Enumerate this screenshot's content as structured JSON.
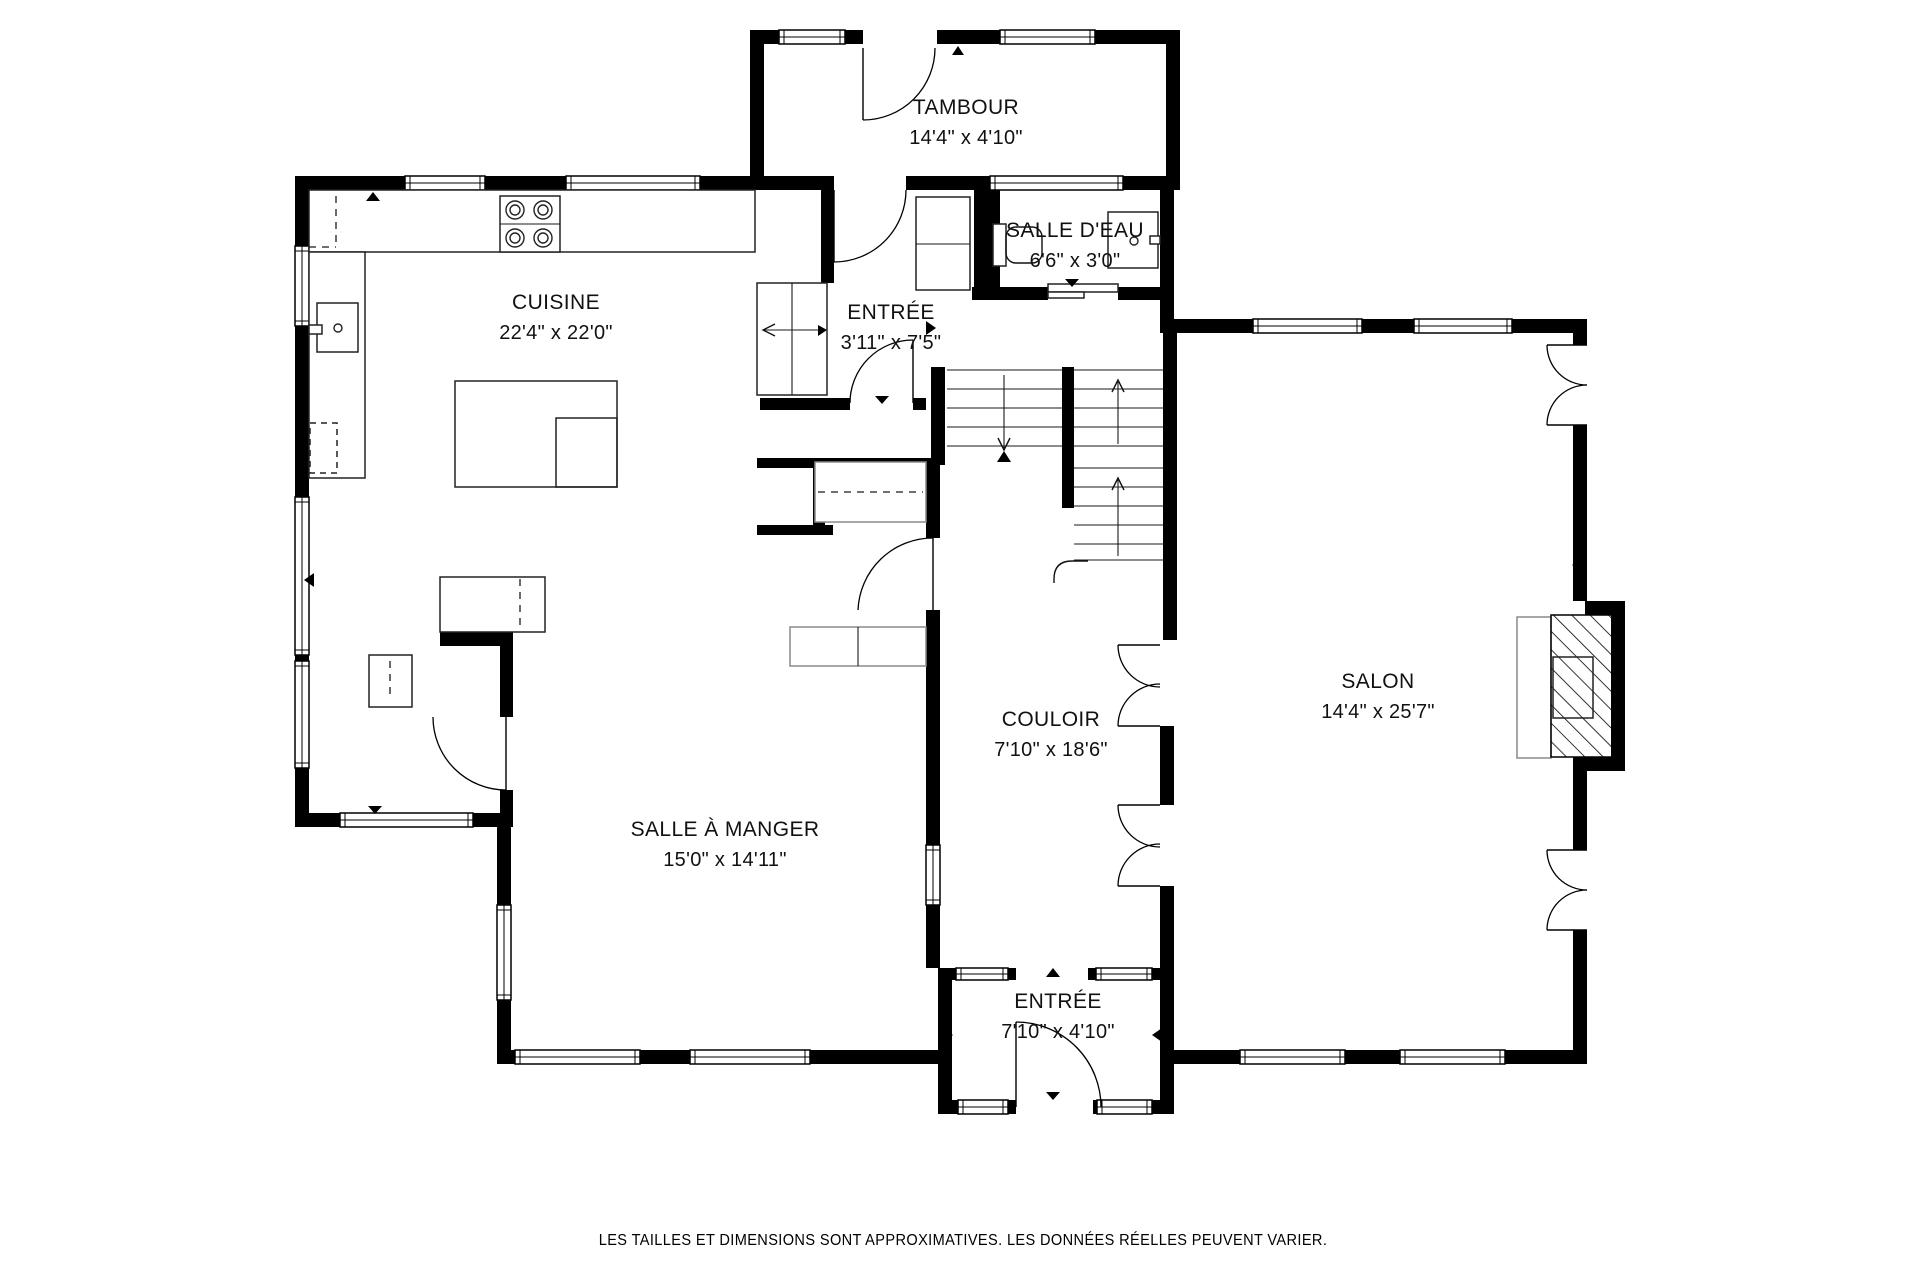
{
  "footer": {
    "disclaimer": "LES TAILLES ET DIMENSIONS SONT APPROXIMATIVES. LES DONNÉES RÉELLES PEUVENT VARIER."
  },
  "rooms": {
    "tambour": {
      "name": "TAMBOUR",
      "dims": "14'4\" x 4'10\"",
      "x": 966,
      "y": 96
    },
    "salle_deau": {
      "name": "SALLE D'EAU",
      "dims": "6'6\" x 3'0\"",
      "x": 1075,
      "y": 219
    },
    "entree_haut": {
      "name": "ENTRÉE",
      "dims": "3'11\" x 7'5\"",
      "x": 891,
      "y": 301
    },
    "cuisine": {
      "name": "CUISINE",
      "dims": "22'4\" x 22'0\"",
      "x": 556,
      "y": 291
    },
    "couloir": {
      "name": "COULOIR",
      "dims": "7'10\" x 18'6\"",
      "x": 1051,
      "y": 708
    },
    "salon": {
      "name": "SALON",
      "dims": "14'4\" x 25'7\"",
      "x": 1378,
      "y": 670
    },
    "salle_a_manger": {
      "name": "SALLE À MANGER",
      "dims": "15'0\" x 14'11\"",
      "x": 725,
      "y": 818
    },
    "entree_bas": {
      "name": "ENTRÉE",
      "dims": "7'10\" x 4'10\"",
      "x": 1058,
      "y": 990
    }
  },
  "colors": {
    "wall": "#000000",
    "line": "#1a1a1a",
    "gray": "#8a8a8a",
    "paper": "#ffffff"
  },
  "plan": {
    "walls": [
      [
        750,
        30,
        14,
        160
      ],
      [
        1166,
        30,
        14,
        160
      ],
      [
        750,
        30,
        29,
        14
      ],
      [
        845,
        30,
        18,
        14
      ],
      [
        937,
        30,
        63,
        14
      ],
      [
        1095,
        30,
        85,
        14
      ],
      [
        295,
        176,
        110,
        14
      ],
      [
        485,
        176,
        81,
        14
      ],
      [
        700,
        176,
        134,
        14
      ],
      [
        906,
        176,
        84,
        14
      ],
      [
        1123,
        176,
        57,
        14
      ],
      [
        295,
        176,
        14,
        70
      ],
      [
        295,
        326,
        14,
        171
      ],
      [
        295,
        655,
        14,
        6
      ],
      [
        295,
        768,
        14,
        59
      ],
      [
        295,
        813,
        45,
        14
      ],
      [
        473,
        813,
        40,
        14
      ],
      [
        497,
        827,
        14,
        78
      ],
      [
        497,
        1000,
        14,
        64
      ],
      [
        497,
        1050,
        18,
        14
      ],
      [
        640,
        1050,
        50,
        14
      ],
      [
        810,
        1050,
        142,
        14
      ],
      [
        440,
        632,
        73,
        14
      ],
      [
        500,
        646,
        13,
        71
      ],
      [
        500,
        790,
        13,
        37
      ],
      [
        821,
        190,
        13,
        93
      ],
      [
        760,
        398,
        90,
        12
      ],
      [
        913,
        398,
        13,
        12
      ],
      [
        974,
        190,
        26,
        110
      ],
      [
        1160,
        190,
        14,
        143
      ],
      [
        972,
        287,
        76,
        13
      ],
      [
        1118,
        287,
        56,
        13
      ],
      [
        757,
        458,
        178,
        10
      ],
      [
        813,
        468,
        12,
        57
      ],
      [
        757,
        525,
        76,
        10
      ],
      [
        926,
        460,
        14,
        78
      ],
      [
        926,
        610,
        14,
        235
      ],
      [
        926,
        905,
        14,
        63
      ],
      [
        931,
        367,
        14,
        98
      ],
      [
        1062,
        367,
        12,
        141
      ],
      [
        1163,
        333,
        14,
        307
      ],
      [
        1160,
        726,
        14,
        79
      ],
      [
        1160,
        886,
        14,
        82
      ],
      [
        938,
        968,
        14,
        146
      ],
      [
        1160,
        968,
        14,
        146
      ],
      [
        938,
        968,
        19,
        12
      ],
      [
        1008,
        968,
        8,
        12
      ],
      [
        1088,
        968,
        8,
        12
      ],
      [
        1152,
        968,
        22,
        12
      ],
      [
        938,
        1100,
        20,
        14
      ],
      [
        1008,
        1100,
        8,
        14
      ],
      [
        1093,
        1100,
        4,
        14
      ],
      [
        1152,
        1100,
        22,
        14
      ],
      [
        1174,
        319,
        79,
        14
      ],
      [
        1362,
        319,
        52,
        14
      ],
      [
        1512,
        319,
        75,
        14
      ],
      [
        1573,
        319,
        14,
        26
      ],
      [
        1573,
        425,
        14,
        176
      ],
      [
        1585,
        601,
        40,
        14
      ],
      [
        1611,
        601,
        14,
        170
      ],
      [
        1585,
        757,
        40,
        14
      ],
      [
        1573,
        757,
        14,
        93
      ],
      [
        1573,
        930,
        14,
        134
      ],
      [
        1174,
        1050,
        66,
        14
      ],
      [
        1345,
        1050,
        55,
        14
      ],
      [
        1505,
        1050,
        82,
        14
      ]
    ],
    "windows": [
      [
        779,
        30,
        66,
        14
      ],
      [
        1000,
        30,
        95,
        14
      ],
      [
        405,
        176,
        80,
        14
      ],
      [
        566,
        176,
        134,
        14
      ],
      [
        990,
        176,
        133,
        14
      ],
      [
        295,
        246,
        14,
        80
      ],
      [
        295,
        497,
        14,
        158
      ],
      [
        295,
        661,
        14,
        107
      ],
      [
        340,
        813,
        133,
        14
      ],
      [
        497,
        905,
        14,
        95
      ],
      [
        515,
        1050,
        125,
        14
      ],
      [
        690,
        1050,
        120,
        14
      ],
      [
        926,
        845,
        14,
        60
      ],
      [
        956,
        968,
        52,
        12
      ],
      [
        1096,
        968,
        56,
        12
      ],
      [
        958,
        1100,
        50,
        14
      ],
      [
        1097,
        1100,
        55,
        14
      ],
      [
        1253,
        319,
        109,
        14
      ],
      [
        1414,
        319,
        98,
        14
      ],
      [
        1240,
        1050,
        105,
        14
      ],
      [
        1400,
        1050,
        105,
        14
      ]
    ],
    "thin": [
      [
        309,
        190,
        446,
        62,
        "kitchen-counter-top",
        0
      ],
      [
        309,
        252,
        56,
        226,
        "kitchen-counter-left",
        0
      ],
      [
        500,
        196,
        60,
        56,
        "stove",
        0
      ],
      [
        317,
        303,
        41,
        49,
        "kitchen-sink",
        0
      ],
      [
        309,
        325,
        13,
        9,
        "sink-faucet",
        0
      ],
      [
        310,
        423,
        27,
        50,
        "dishwasher",
        2
      ],
      [
        455,
        381,
        162,
        106,
        "kitchen-island",
        0
      ],
      [
        556,
        418,
        61,
        69,
        "island-inner",
        4
      ],
      [
        757,
        283,
        70,
        112,
        "entry-closet",
        0
      ],
      [
        916,
        197,
        54,
        93,
        "hall-cabinet",
        0
      ],
      [
        815,
        462,
        111,
        60,
        "coat-closet",
        1
      ],
      [
        440,
        577,
        105,
        55,
        "cabinet-counter",
        0
      ],
      [
        369,
        655,
        43,
        52,
        "small-cabinet",
        0
      ],
      [
        790,
        627,
        136,
        39,
        "hall-bench",
        1
      ],
      [
        1517,
        617,
        34,
        141,
        "hearth",
        1
      ],
      [
        1551,
        615,
        61,
        142,
        "fireplace",
        3
      ],
      [
        1553,
        657,
        40,
        61,
        "fireplace-insert",
        4
      ],
      [
        993,
        224,
        13,
        42,
        "toilet-tank",
        0
      ],
      [
        1108,
        212,
        50,
        56,
        "powder-sink",
        0
      ],
      [
        1150,
        236,
        10,
        8,
        "powder-faucet",
        0
      ],
      [
        1048,
        284,
        70,
        8,
        "pocket-door",
        0
      ],
      [
        1048,
        292,
        36,
        6,
        "pocket-door-track",
        0
      ]
    ],
    "lines": [
      [
        792,
        283,
        792,
        395
      ],
      [
        858,
        627,
        858,
        666
      ],
      [
        500,
        224,
        560,
        224
      ],
      [
        916,
        244,
        970,
        244
      ],
      [
        947,
        370,
        1062,
        370
      ],
      [
        947,
        389,
        1062,
        389
      ],
      [
        947,
        408,
        1062,
        408
      ],
      [
        947,
        427,
        1062,
        427
      ],
      [
        947,
        446,
        1062,
        446
      ],
      [
        1074,
        370,
        1163,
        370
      ],
      [
        1074,
        389,
        1163,
        389
      ],
      [
        1074,
        408,
        1163,
        408
      ],
      [
        1074,
        427,
        1163,
        427
      ],
      [
        1074,
        446,
        1163,
        446
      ],
      [
        1074,
        468,
        1163,
        468
      ],
      [
        1074,
        487,
        1163,
        487
      ],
      [
        1074,
        506,
        1163,
        506
      ],
      [
        1074,
        525,
        1163,
        525
      ],
      [
        1074,
        544,
        1163,
        544
      ],
      [
        1074,
        560,
        1163,
        560
      ],
      [
        1118,
        382,
        1118,
        444
      ],
      [
        1118,
        480,
        1118,
        556
      ],
      [
        1004,
        375,
        1004,
        448
      ],
      [
        763,
        330,
        824,
        330
      ]
    ],
    "dashed": [
      [
        336,
        196,
        336,
        247
      ],
      [
        309,
        247,
        336,
        247
      ],
      [
        818,
        492,
        923,
        492
      ],
      [
        520,
        579,
        520,
        630
      ],
      [
        390,
        661,
        390,
        700
      ]
    ],
    "doors": [
      [
        863,
        48,
        863,
        120,
        "M863,120 A72,72 0 0 0 935,48"
      ],
      [
        834,
        190,
        834,
        262,
        "M834,262 A72,72 0 0 0 906,190"
      ],
      [
        913,
        340,
        913,
        403,
        "M850,403 A63,63 0 0 1 913,340"
      ],
      [
        506,
        717,
        506,
        790,
        "M506,790 A73,73 0 0 1 433,717"
      ],
      [
        933,
        538,
        933,
        610,
        "M933,538 A75,75 0 0 0 858,610"
      ],
      [
        1016,
        1022,
        1016,
        1107,
        "M1016,1022 A85,85 0 0 1 1101,1107"
      ],
      [
        1160,
        645,
        1118,
        645,
        "M1118,645 A42,42 0 0 0 1160,687"
      ],
      [
        1160,
        726,
        1118,
        726,
        "M1118,726 A42,42 0 0 1 1160,684"
      ],
      [
        1160,
        805,
        1118,
        805,
        "M1118,805 A42,42 0 0 0 1160,847"
      ],
      [
        1160,
        886,
        1118,
        886,
        "M1118,886 A42,42 0 0 1 1160,844"
      ],
      [
        1587,
        345,
        1547,
        345,
        "M1547,345 A40,40 0 0 0 1587,385"
      ],
      [
        1587,
        425,
        1547,
        425,
        "M1547,425 A40,40 0 0 1 1587,385"
      ],
      [
        1587,
        850,
        1547,
        850,
        "M1547,850 A40,40 0 0 0 1587,890"
      ],
      [
        1587,
        930,
        1547,
        930,
        "M1547,930 A40,40 0 0 1 1587,890"
      ]
    ],
    "paths": [
      [
        "M1088,561 H1072 Q1054,561 1054,579 V583",
        "stair-handrail"
      ],
      [
        "M998,438 L1004,450 L1010,438",
        "stair-down-arrowhead"
      ],
      [
        "M1112,392 L1118,380 L1124,392",
        "stair-up-arrowhead-1"
      ],
      [
        "M1112,490 L1118,478 L1124,490",
        "stair-up-arrowhead-2"
      ],
      [
        "M775,324 L763,330 L775,336",
        "closet-slide-arrowhead"
      ],
      [
        "M1016,227 h16 a10,10 0 0 1 10,10 v16 a10,10 0 0 1 -10,10 h-16 a10,10 0 0 1 -10,-10 v-16 a10,10 0 0 1 10,-10 Z",
        "toilet-bowl"
      ]
    ],
    "tris": [
      "952,55 964,55 958,46",
      "366,201 380,201 373,192",
      "953,178 967,178 960,186",
      "875,396 889,396 882,404",
      "1065,279 1079,279 1072,287",
      "926,321 926,335 936,328",
      "314,573 314,587 304,580",
      "368,806 382,806 375,814",
      "1046,977 1060,977 1053,968",
      "1046,1092 1060,1092 1053,1100",
      "943,1028 943,1042 953,1035",
      "1162,1028 1162,1042 1152,1035",
      "1582,558 1582,572 1572,565",
      "1174,559 1174,573 1164,566",
      "818,325 818,336 827,330",
      "997,462 1011,462 1004,451"
    ],
    "circles": [
      [
        515,
        210,
        9
      ],
      [
        515,
        210,
        5
      ],
      [
        543,
        210,
        9
      ],
      [
        543,
        210,
        5
      ],
      [
        515,
        238,
        9
      ],
      [
        515,
        238,
        5
      ],
      [
        543,
        238,
        9
      ],
      [
        543,
        238,
        5
      ],
      [
        338,
        328,
        4
      ],
      [
        1134,
        241,
        4
      ]
    ]
  }
}
